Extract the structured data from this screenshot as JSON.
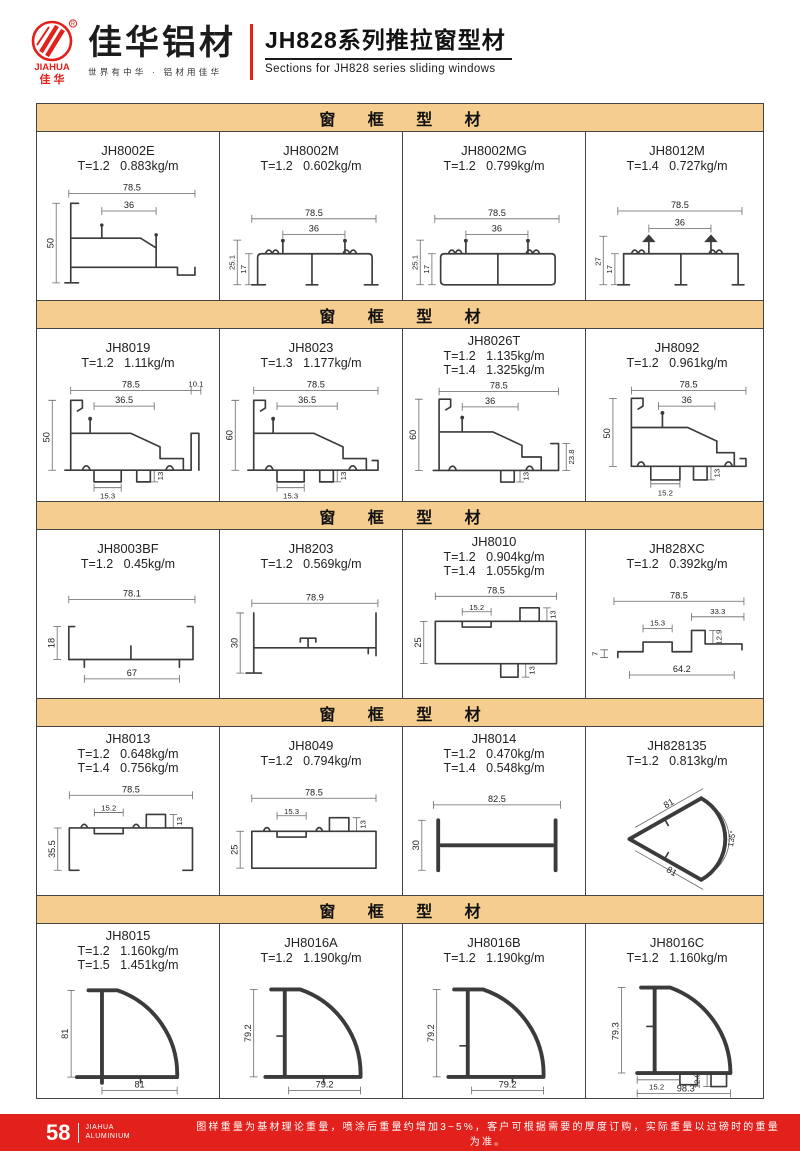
{
  "header": {
    "logo_en": "JIAHUA",
    "logo_cn": "佳 华",
    "reg_mark": "R",
    "brand_title": "佳华铝材",
    "brand_tagline": "世界有中华 · 铝材用佳华",
    "series_title": "JH828系列推拉窗型材",
    "series_subtitle": "Sections for JH828 series sliding windows"
  },
  "colors": {
    "accent_red": "#e2211c",
    "section_header_bg": "#f5cd8e",
    "drawing_stroke": "#3b3b3b"
  },
  "sections": [
    {
      "title": "窗 框 型 材",
      "cells": [
        {
          "code": "JH8002E",
          "spec1": "T=1.2   0.883kg/m",
          "dims": [
            "78.5",
            "36",
            "50"
          ]
        },
        {
          "code": "JH8002M",
          "spec1": "T=1.2   0.602kg/m",
          "dims": [
            "78.5",
            "36",
            "25.1",
            "17"
          ]
        },
        {
          "code": "JH8002MG",
          "spec1": "T=1.2   0.799kg/m",
          "dims": [
            "78.5",
            "36",
            "25.1",
            "17"
          ]
        },
        {
          "code": "JH8012M",
          "spec1": "T=1.4   0.727kg/m",
          "dims": [
            "78.5",
            "36",
            "27",
            "17"
          ]
        }
      ]
    },
    {
      "title": "窗 框 型 材",
      "cells": [
        {
          "code": "JH8019",
          "spec1": "T=1.2   1.11kg/m",
          "dims": [
            "78.5",
            "10.1",
            "36.5",
            "50",
            "15.3",
            "13"
          ]
        },
        {
          "code": "JH8023",
          "spec1": "T=1.3   1.177kg/m",
          "dims": [
            "78.5",
            "36.5",
            "60",
            "15.3",
            "13"
          ]
        },
        {
          "code": "JH8026T",
          "spec1": "T=1.2   1.135kg/m",
          "spec2": "T=1.4   1.325kg/m",
          "dims": [
            "78.5",
            "36",
            "60",
            "23.8",
            "13"
          ]
        },
        {
          "code": "JH8092",
          "spec1": "T=1.2   0.961kg/m",
          "dims": [
            "78.5",
            "36",
            "50",
            "15.2",
            "13"
          ]
        }
      ]
    },
    {
      "title": "窗 框 型 材",
      "cells": [
        {
          "code": "JH8003BF",
          "spec1": "T=1.2   0.45kg/m",
          "dims": [
            "78.1",
            "18",
            "67"
          ]
        },
        {
          "code": "JH8203",
          "spec1": "T=1.2   0.569kg/m",
          "dims": [
            "78.9",
            "30"
          ]
        },
        {
          "code": "JH8010",
          "spec1": "T=1.2   0.904kg/m",
          "spec2": "T=1.4   1.055kg/m",
          "dims": [
            "78.5",
            "15.2",
            "13",
            "25",
            "13"
          ]
        },
        {
          "code": "JH828XC",
          "spec1": "T=1.2   0.392kg/m",
          "dims": [
            "78.5",
            "33.3",
            "15.3",
            "12.9",
            "7",
            "64.2"
          ]
        }
      ]
    },
    {
      "title": "窗 框 型 材",
      "cells": [
        {
          "code": "JH8013",
          "spec1": "T=1.2   0.648kg/m",
          "spec2": "T=1.4   0.756kg/m",
          "dims": [
            "78.5",
            "15.2",
            "13",
            "35.5"
          ]
        },
        {
          "code": "JH8049",
          "spec1": "T=1.2   0.794kg/m",
          "dims": [
            "78.5",
            "15.3",
            "13",
            "25"
          ]
        },
        {
          "code": "JH8014",
          "spec1": "T=1.2   0.470kg/m",
          "spec2": "T=1.4   0.548kg/m",
          "dims": [
            "82.5",
            "30"
          ]
        },
        {
          "code": "JH828135",
          "spec1": "T=1.2   0.813kg/m",
          "dims": [
            "81",
            "81",
            "135°"
          ]
        }
      ]
    },
    {
      "title": "窗 框 型 材",
      "cells": [
        {
          "code": "JH8015",
          "spec1": "T=1.2   1.160kg/m",
          "spec2": "T=1.5   1.451kg/m",
          "dims": [
            "81",
            "81"
          ]
        },
        {
          "code": "JH8016A",
          "spec1": "T=1.2   1.190kg/m",
          "dims": [
            "79.2",
            "79.2"
          ]
        },
        {
          "code": "JH8016B",
          "spec1": "T=1.2   1.190kg/m",
          "dims": [
            "79.2",
            "79.2"
          ]
        },
        {
          "code": "JH8016C",
          "spec1": "T=1.2   1.160kg/m",
          "dims": [
            "79.3",
            "15.2",
            "12.9",
            "98.3"
          ]
        }
      ]
    }
  ],
  "footer": {
    "page_number": "58",
    "brand_line1": "JIAHUA",
    "brand_line2": "ALUMINIUM",
    "note": "图样重量为基材理论重量，喷涂后重量约增加3~5%，客户可根据需要的厚度订购，实际重量以过磅时的重量为准。"
  }
}
